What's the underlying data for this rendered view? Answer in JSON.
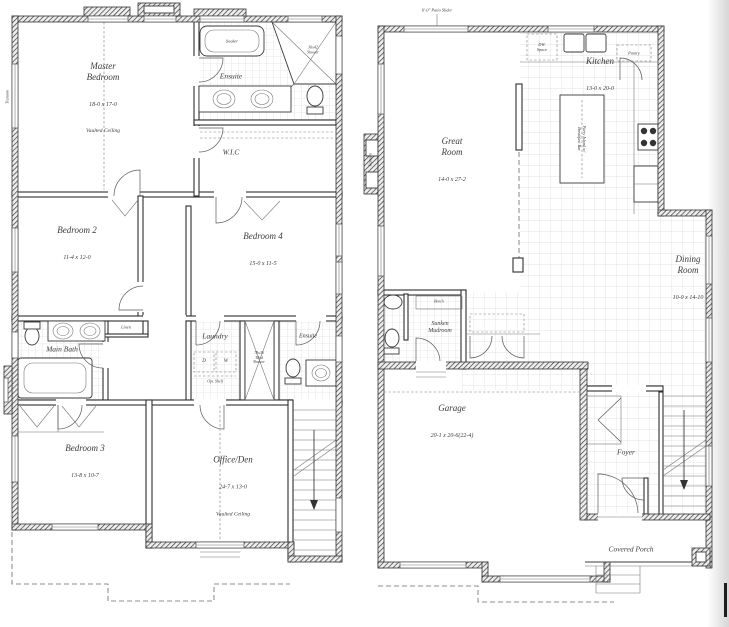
{
  "document": {
    "type": "architectural floor plan, two storeys side by side"
  },
  "colors": {
    "ink": "#2f2f2f",
    "wall_hatch": "#3a3a3a",
    "tile_line": "#d6d6d6",
    "background": "#ffffff"
  },
  "labels": {
    "left": {
      "transom": "Transom",
      "master": {
        "name": "Master\nBedroom",
        "dims": "18-0 x 17-0",
        "note": "Vaulted Ceiling"
      },
      "ensuite": "Ensuite",
      "soaker": "Soaker",
      "corner_shower": "36x42\nShower",
      "wic": "W.I.C",
      "bedroom2": {
        "name": "Bedroom 2",
        "dims": "11-4 x 12-0"
      },
      "bedroom4": {
        "name": "Bedroom 4",
        "dims": "15-0 x 11-5"
      },
      "linen": "Linen",
      "main_bath": "Main Bath",
      "laundry": "Laundry",
      "dryer": "D",
      "washer": "W",
      "opt_shelf": "Opt. Shelf",
      "tiled_shower": "78x36\nTiled\nShower",
      "ensuite2": "Ensuite",
      "bedroom3": {
        "name": "Bedroom 3",
        "dims": "13-8 x 10-7"
      },
      "office": {
        "name": "Office/Den",
        "dims": "24-7 x 13-0",
        "note": "Vaulted Ceiling"
      }
    },
    "right": {
      "patio_slider": "6'-0\" Patio Slider",
      "transom": "Transom",
      "dw_space": "DW.\nSpace",
      "kitchen": {
        "name": "Kitchen",
        "dims": "13-0 x 20-0"
      },
      "pantry": "Pantry",
      "island": "Party Island w/\nBreakfast Bar",
      "great_room": {
        "name": "Great\nRoom",
        "dims": "14-0 x 27-2"
      },
      "dining": {
        "name": "Dining\nRoom",
        "dims": "10-0 x 14-10"
      },
      "bench": "Bench",
      "mudroom": "Sunken\nMudroom",
      "garage": {
        "name": "Garage",
        "dims": "20-1 x 20-6(22-4)"
      },
      "foyer": "Foyer",
      "covered_porch": "Covered Porch"
    }
  }
}
